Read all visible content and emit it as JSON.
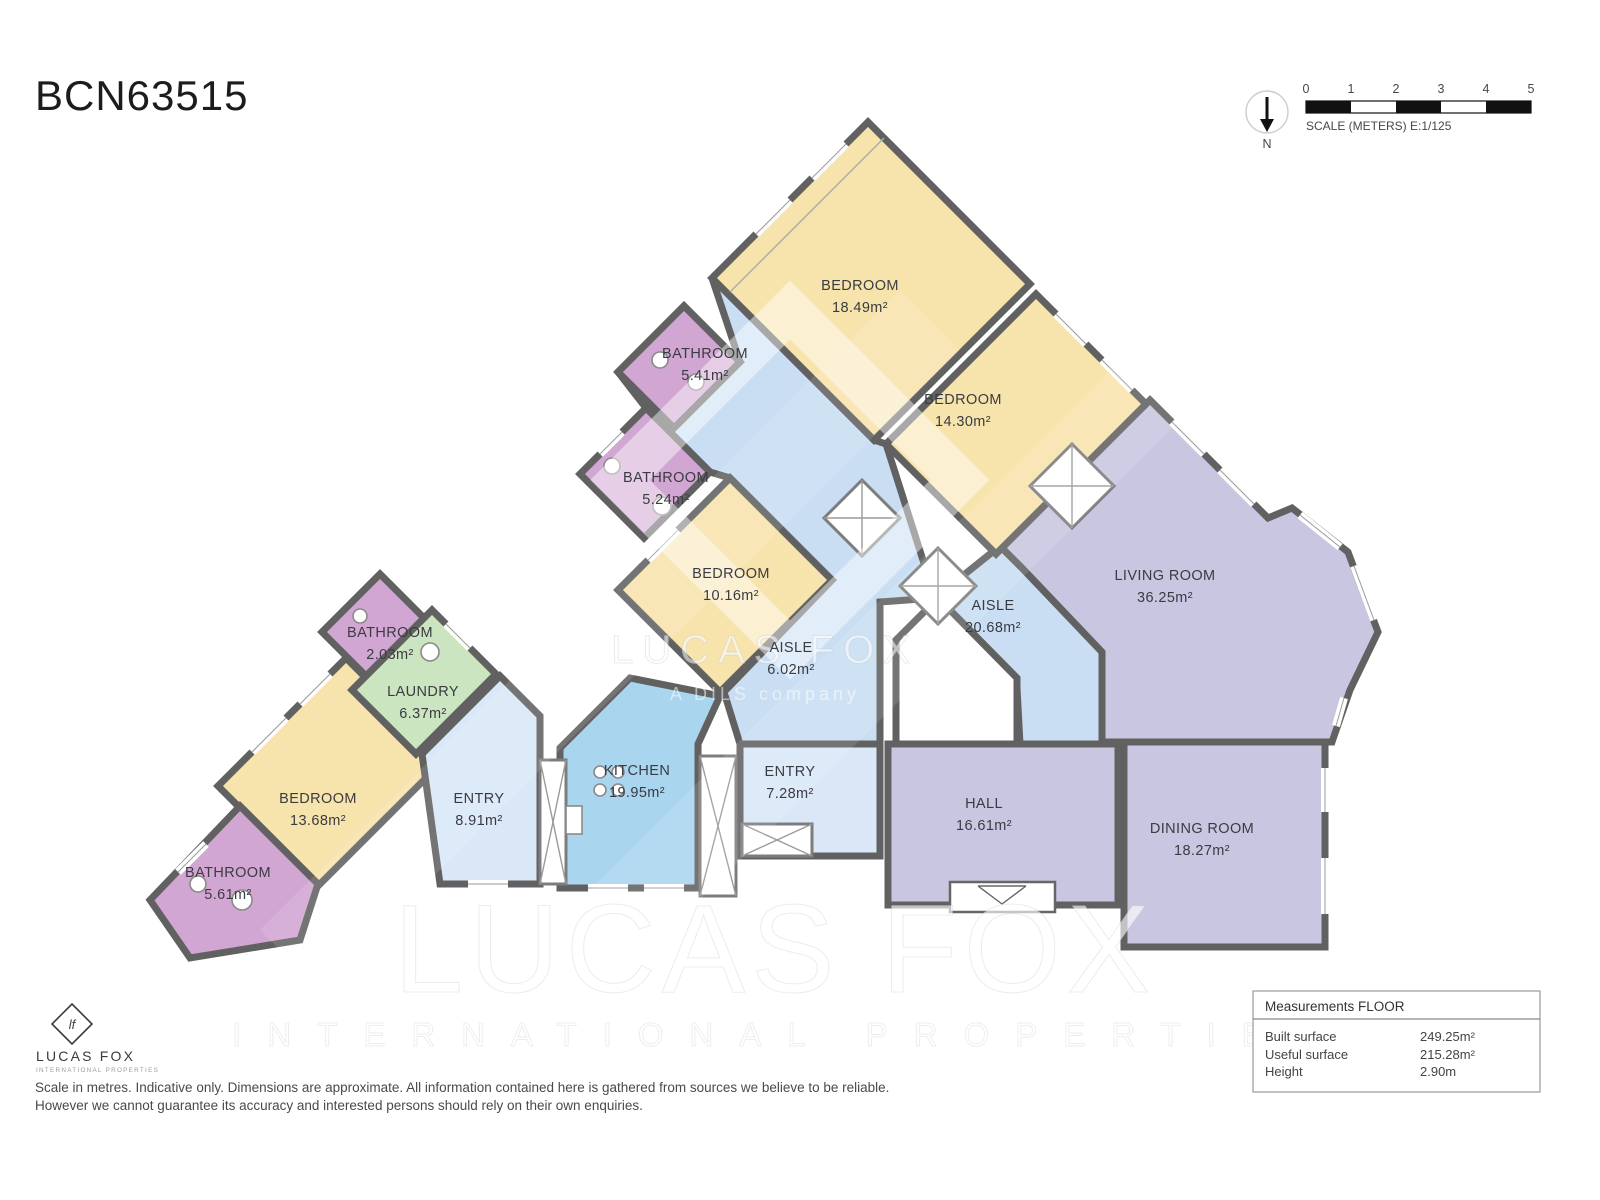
{
  "title": "BCN63515",
  "compass": {
    "label": "N"
  },
  "scalebar": {
    "ticks": [
      "0",
      "1",
      "2",
      "3",
      "4",
      "5"
    ],
    "caption": "SCALE (METERS) E:1/125"
  },
  "palette": {
    "bedroom": "#F7E3AC",
    "bathroom": "#D2A6D2",
    "aisle": "#C9DEF2",
    "entry": "#D9E7F7",
    "kitchen": "#A9D5EE",
    "laundry": "#CBE5C0",
    "lounge": "#C9C6E1",
    "wall": "#616161"
  },
  "rooms": [
    {
      "name": "BEDROOM",
      "area": "18.49m²"
    },
    {
      "name": "BEDROOM",
      "area": "14.30m²"
    },
    {
      "name": "BATHROOM",
      "area": "5.41m²"
    },
    {
      "name": "BATHROOM",
      "area": "5.24m²"
    },
    {
      "name": "BEDROOM",
      "area": "10.16m²"
    },
    {
      "name": "AISLE",
      "area": "6.02m²"
    },
    {
      "name": "AISLE",
      "area": "20.68m²"
    },
    {
      "name": "LIVING ROOM",
      "area": "36.25m²"
    },
    {
      "name": "ENTRY",
      "area": "7.28m²"
    },
    {
      "name": "HALL",
      "area": "16.61m²"
    },
    {
      "name": "DINING ROOM",
      "area": "18.27m²"
    },
    {
      "name": "KITCHEN",
      "area": "19.95m²"
    },
    {
      "name": "ENTRY",
      "area": "8.91m²"
    },
    {
      "name": "LAUNDRY",
      "area": "6.37m²"
    },
    {
      "name": "BATHROOM",
      "area": "2.03m²"
    },
    {
      "name": "BEDROOM",
      "area": "13.68m²"
    },
    {
      "name": "BATHROOM",
      "area": "5.61m²"
    }
  ],
  "watermark": {
    "center_line1": "LUCAS FOX",
    "center_line2": "A DILS company",
    "big_line1": "LUCAS FOX",
    "big_line2": "INTERNATIONAL PROPERTIES"
  },
  "logo": {
    "monogram": "lf",
    "name": "LUCAS FOX",
    "tagline": "INTERNATIONAL PROPERTIES"
  },
  "disclaimer": {
    "line1": "Scale in metres. Indicative only. Dimensions are approximate. All information contained here is gathered from sources we believe to be reliable.",
    "line2": "However we cannot guarantee its accuracy and interested persons should rely on their own enquiries."
  },
  "measurements": {
    "title": "Measurements FLOOR",
    "rows": [
      {
        "label": "Built surface",
        "value": "249.25m²"
      },
      {
        "label": "Useful surface",
        "value": "215.28m²"
      },
      {
        "label": "Height",
        "value": "2.90m"
      }
    ]
  }
}
